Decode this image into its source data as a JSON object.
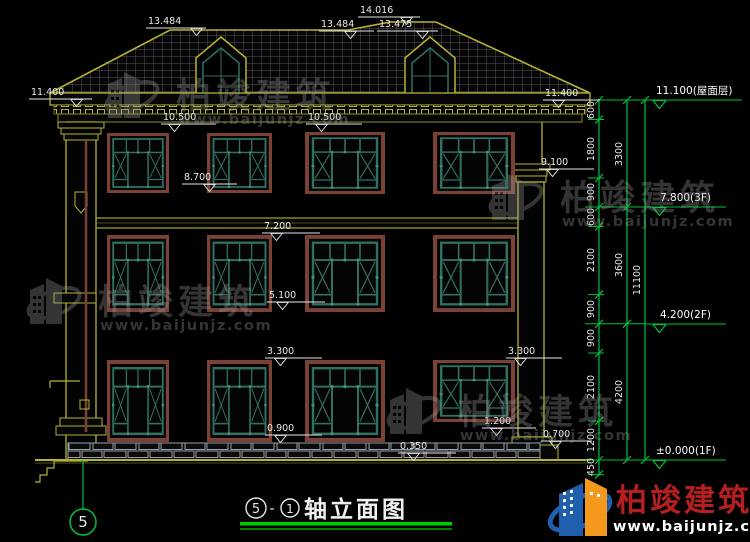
{
  "watermark": {
    "brand": "柏竣建筑",
    "url": "www.baijunjz.com"
  },
  "title_block": {
    "axis_from": "5",
    "separator": "-",
    "axis_to": "1",
    "title": "轴立面图"
  },
  "axis": {
    "left_bubble": "5"
  },
  "elevation_marks": {
    "top": [
      "13.484",
      "14.016",
      "13.484",
      "13.475"
    ],
    "left": [
      "11.400",
      "10.500",
      "10.500",
      "8.700",
      "7.200",
      "5.100",
      "3.300",
      "0.900",
      "0.350"
    ],
    "right": [
      "11.400",
      "9.100",
      "3.300",
      "1.200",
      "0.700"
    ],
    "levels": [
      "11.100(屋面层)",
      "7.800(3F)",
      "4.200(2F)",
      "±0.000(1F)"
    ]
  },
  "dimensions": {
    "inner": [
      "600",
      "1800",
      "900",
      "600",
      "2100",
      "900",
      "900",
      "2100",
      "1200",
      "450"
    ],
    "mid": [
      "3300",
      "3600",
      "4200"
    ],
    "total": "11100"
  },
  "colors": {
    "cad_green": "#00c23c",
    "structure_yellow": "#b5b332",
    "window_frame_maroon": "#7a4236",
    "window_teal": "#2f7060",
    "brand_red": "#b51f1f",
    "brand_blue": "#1f5fae",
    "brand_orange": "#f5991d"
  }
}
